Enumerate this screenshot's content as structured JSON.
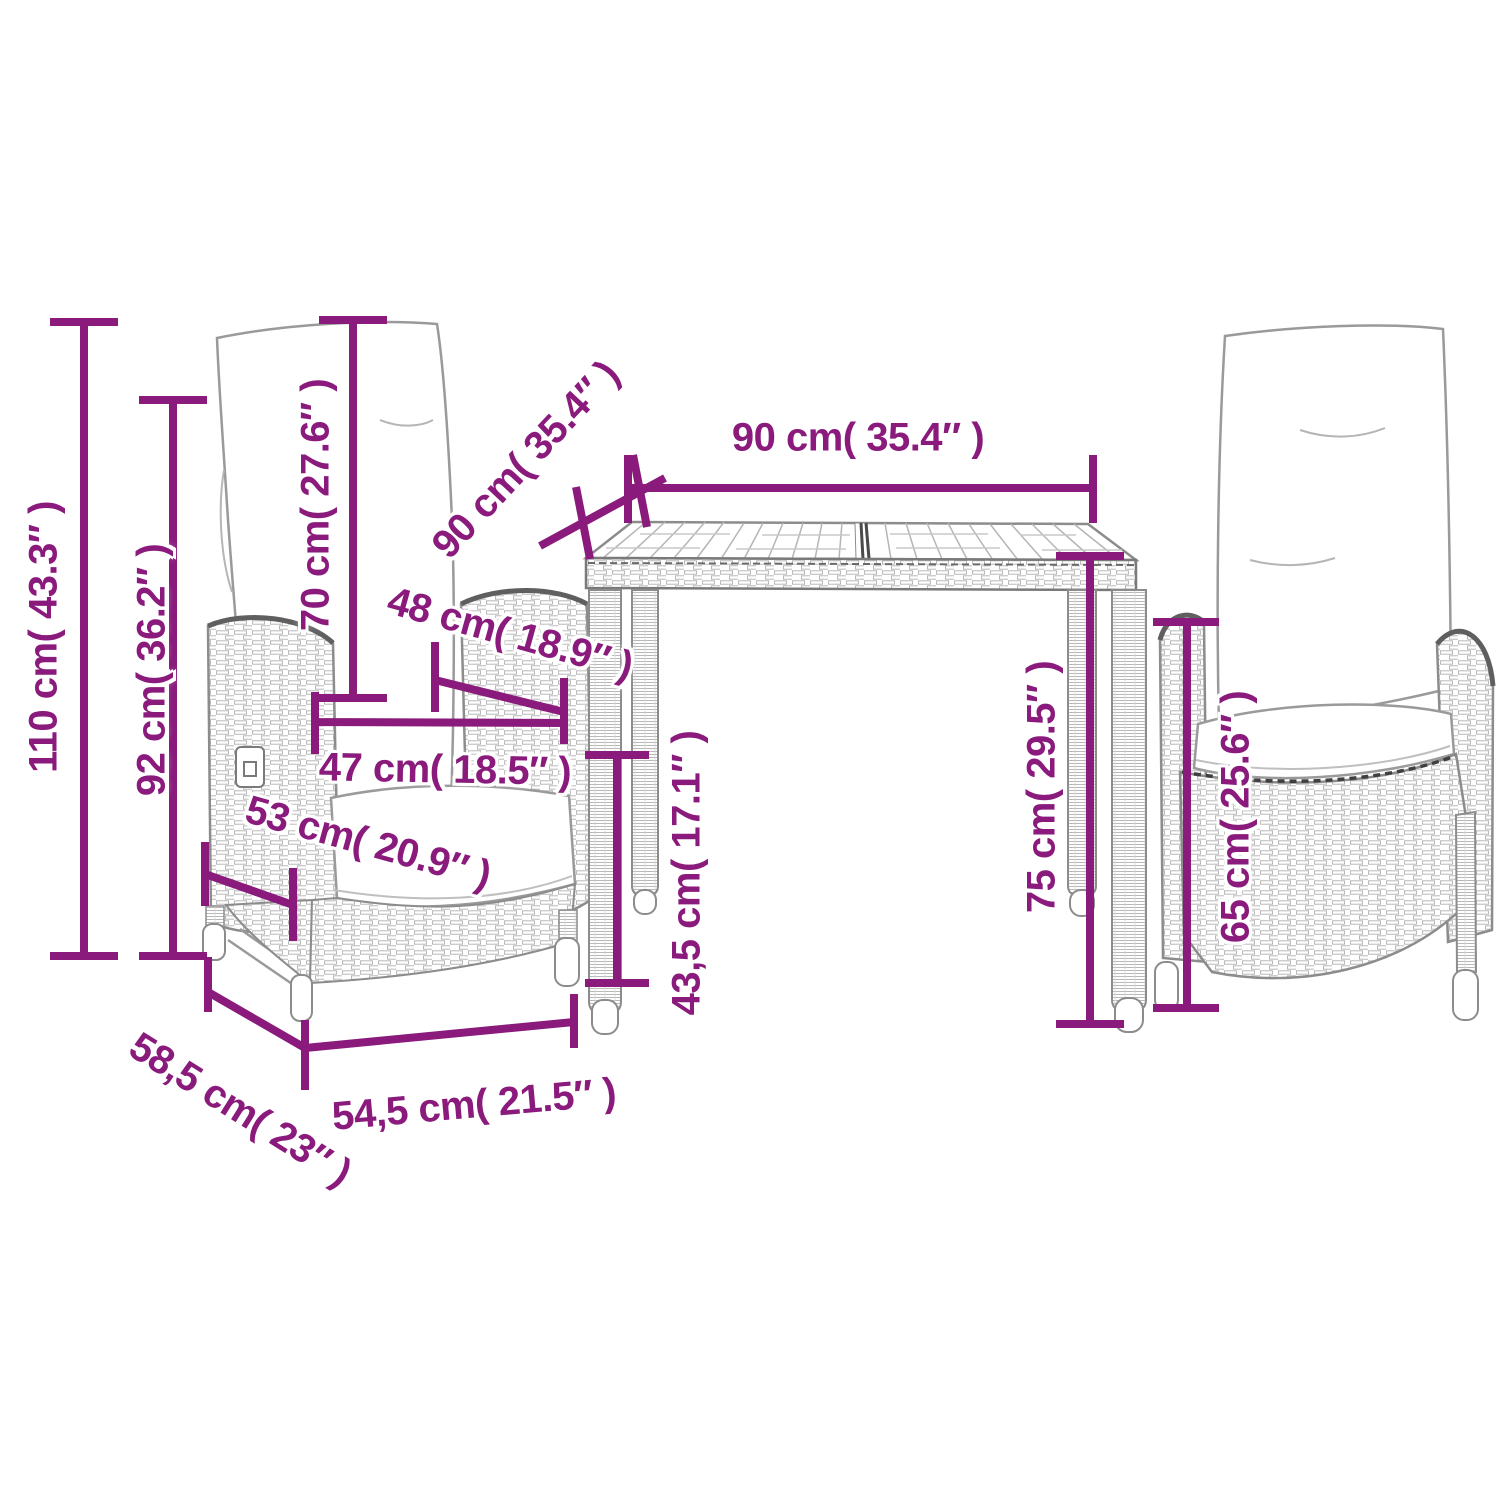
{
  "figure": {
    "type": "product-dimension-diagram",
    "items": [
      "reclining-garden-chair-left",
      "garden-dining-table",
      "reclining-garden-chair-right"
    ],
    "colors": {
      "dimension": "#8a1a7c",
      "lineart": "#8c8c8c",
      "background": "#ffffff"
    },
    "dimensions": {
      "chair_total_height": {
        "label": "110 cm( 43.3″ )"
      },
      "chair_back_height": {
        "label": "92 cm( 36.2″ )"
      },
      "backrest_cushion_height": {
        "label": "70 cm( 27.6″ )"
      },
      "table_depth": {
        "label": "90 cm( 35.4″ )"
      },
      "table_width": {
        "label": "90 cm( 35.4″ )"
      },
      "seat_inner_width": {
        "label": "48 cm( 18.9″ )"
      },
      "seat_front_width": {
        "label": "47 cm( 18.5″ )"
      },
      "seat_depth": {
        "label": "53 cm( 20.9″ )"
      },
      "table_leg_clearance": {
        "label": "43,5 cm( 17.1″ )"
      },
      "table_height": {
        "label": "75 cm( 29.5″ )"
      },
      "armrest_height": {
        "label": "65 cm( 25.6″ )"
      },
      "chair_total_depth": {
        "label": "58,5 cm( 23″ )"
      },
      "chair_front_width": {
        "label": "54,5 cm( 21.5″ )"
      }
    }
  }
}
